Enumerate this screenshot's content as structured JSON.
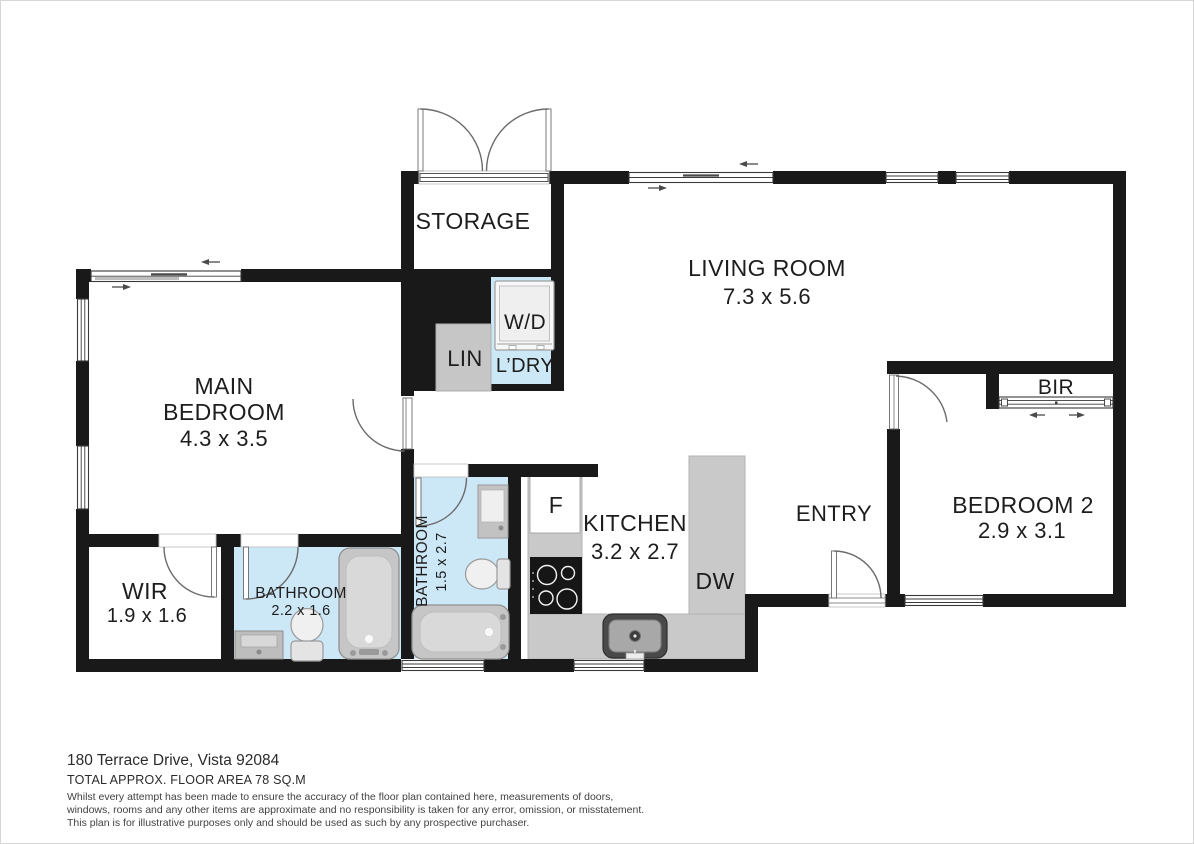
{
  "plan": {
    "labels": {
      "storage": "STORAGE",
      "living_room": "LIVING ROOM",
      "living_room_dims": "7.3 x 5.6",
      "main_bedroom_line1": "MAIN",
      "main_bedroom_line2": "BEDROOM",
      "main_bedroom_dims": "4.3 x 3.5",
      "wir": "WIR",
      "wir_dims": "1.9 x 1.6",
      "bathroom_main": "BATHROOM",
      "bathroom_main_dims": "2.2 x 1.6",
      "bathroom_ensuite": "BATHROOM",
      "bathroom_ensuite_dims": "1.5 x 2.7",
      "kitchen": "KITCHEN",
      "kitchen_dims": "3.2 x 2.7",
      "entry": "ENTRY",
      "bedroom2": "BEDROOM 2",
      "bedroom2_dims": "2.9 x 3.1",
      "bir": "BIR",
      "laundry": "L’DRY",
      "linen": "LIN",
      "washer_dryer": "W/D",
      "fridge": "F",
      "dishwasher": "DW"
    },
    "colors": {
      "wall": "#191919",
      "bath_floor": "#cce7f6",
      "counter": "#c9c9c9",
      "text": "#1d1d1d"
    }
  },
  "footer": {
    "address": "180 Terrace Drive, Vista 92084",
    "area": "TOTAL APPROX. FLOOR AREA 78 SQ.M",
    "disclaimer_line1": "Whilst every attempt has been made to ensure the accuracy of the floor plan contained here, measurements of doors,",
    "disclaimer_line2": "windows, rooms and any other items are approximate and no responsibility is taken for any error, omission, or misstatement.",
    "disclaimer_line3": "This plan is for illustrative purposes only and should be used as such by any prospective purchaser."
  }
}
